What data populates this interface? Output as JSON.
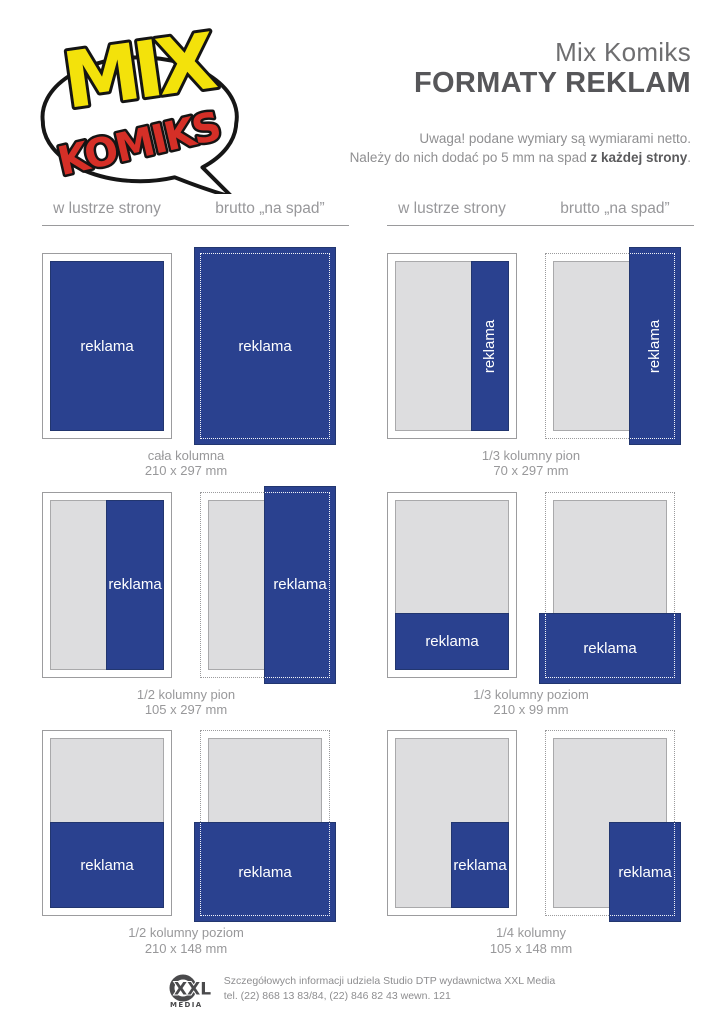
{
  "logo": {
    "mix": "MIX",
    "komiks": "KOMIKS"
  },
  "header": {
    "title": "Mix Komiks",
    "subtitle": "FORMATY REKLAM",
    "note_line1": "Uwaga! podane wymiary są wymiarami netto.",
    "note_line2_prefix": "Należy do nich dodać po 5 mm na spad ",
    "note_line2_bold": "z każdej strony",
    "note_line2_suffix": "."
  },
  "columns_header": {
    "mirror": "w lustrze strony",
    "bleed": "brutto „na spad”"
  },
  "ad_label": "reklama",
  "formats": [
    {
      "name": "cała kolumna",
      "size": "210 x 297 mm",
      "layout": "full"
    },
    {
      "name": "1/3 kolumny pion",
      "size": "70 x 297 mm",
      "layout": "v3"
    },
    {
      "name": "1/2 kolumny pion",
      "size": "105 x 297 mm",
      "layout": "v2"
    },
    {
      "name": "1/3 kolumny poziom",
      "size": "210 x 99 mm",
      "layout": "h3"
    },
    {
      "name": "1/2 kolumny poziom",
      "size": "210 x 148 mm",
      "layout": "h2"
    },
    {
      "name": "1/4 kolumny",
      "size": "105 x 148 mm",
      "layout": "q4"
    }
  ],
  "footer": {
    "logo_line1": "XXL",
    "logo_line2": "MEDIA",
    "line1": "Szczegółowych informacji udziela Studio DTP wydawnictwa XXL Media",
    "line2": "tel. (22) 868 13 83/84, (22) 846 82 43 wewn. 121"
  },
  "colors": {
    "ad_blue": "#2a418f",
    "content_gray": "#dddddf",
    "line_gray": "#9a9a9c"
  }
}
